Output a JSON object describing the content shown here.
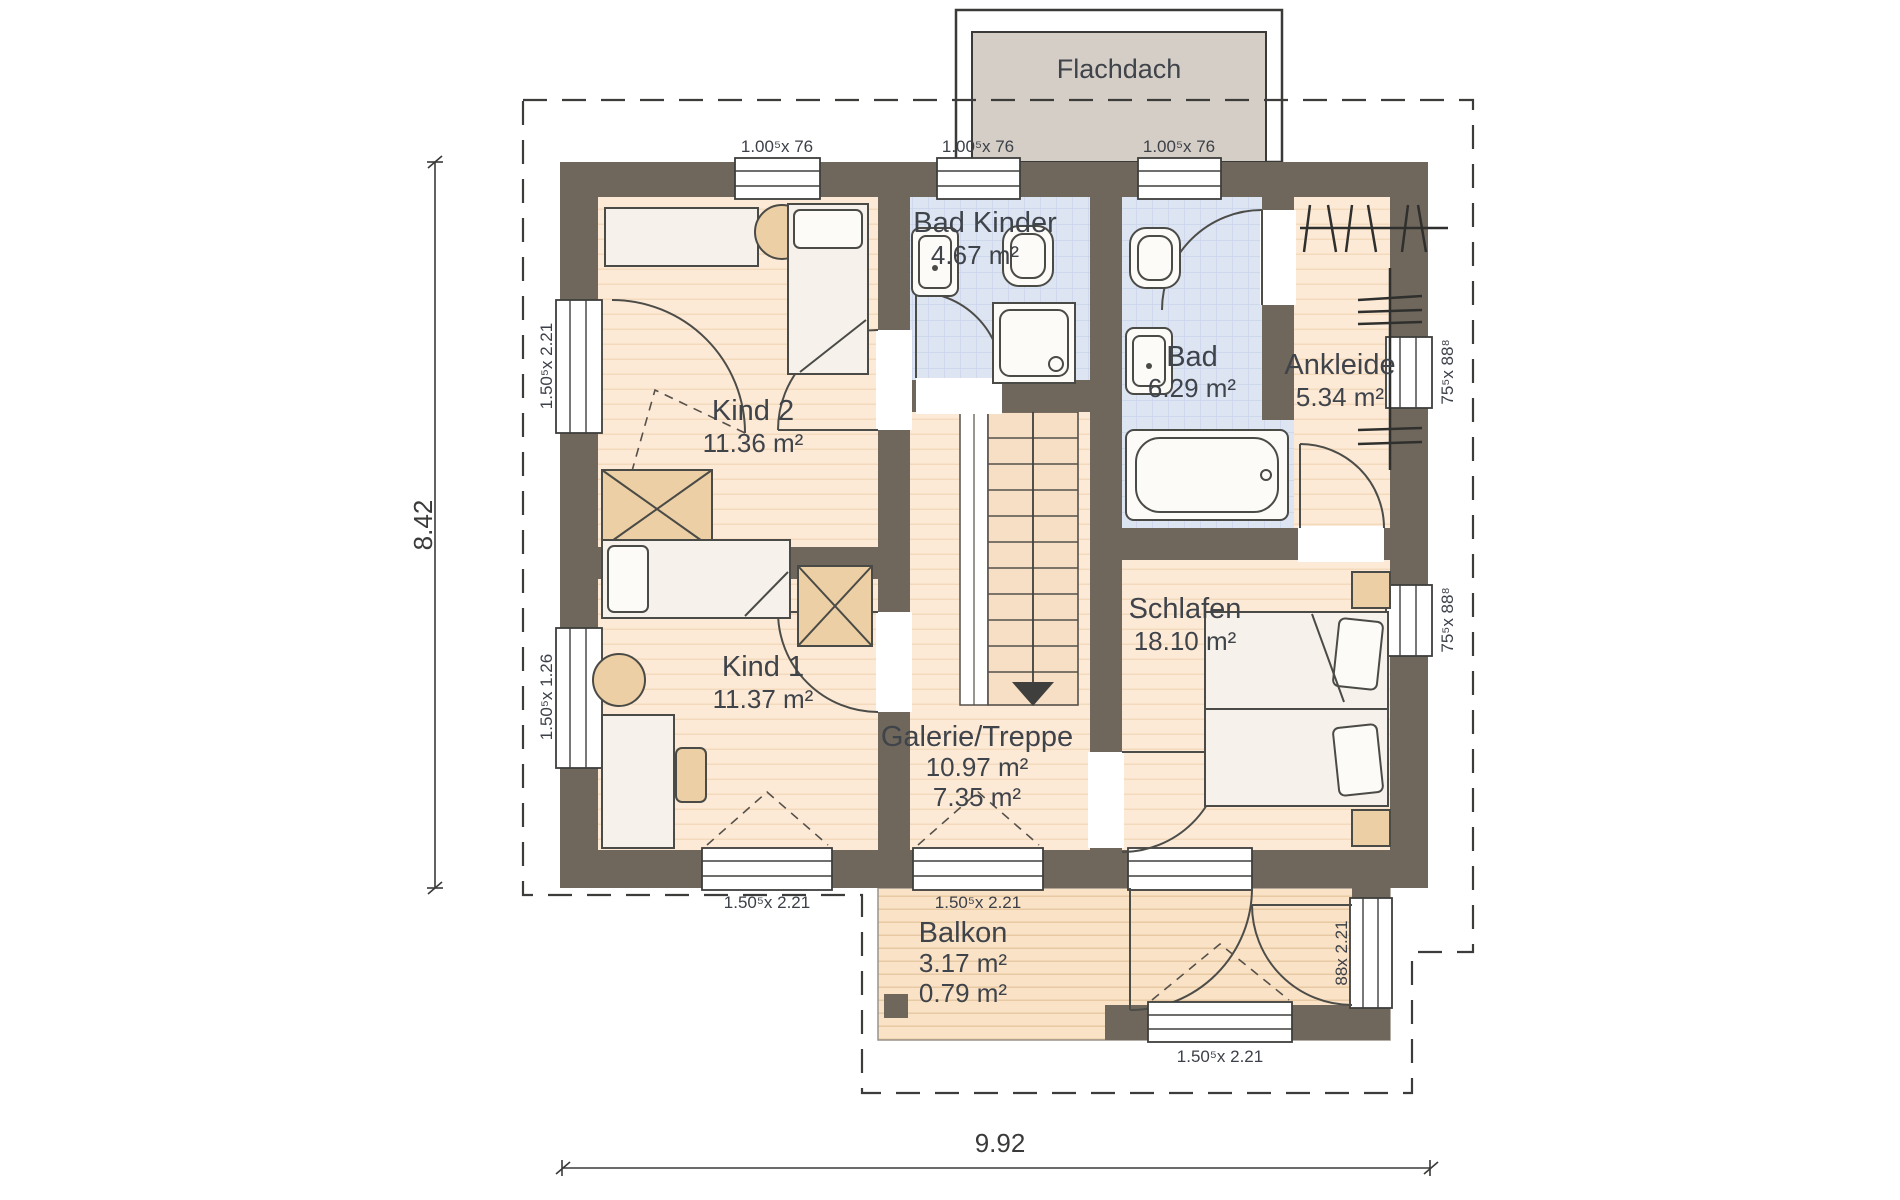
{
  "labels": {
    "roof": "Flachdach",
    "dim_height": "8.42",
    "dim_width": "9.92"
  },
  "rooms": {
    "bad_kinder": {
      "name": "Bad Kinder",
      "area": "4.67 m²"
    },
    "bad": {
      "name": "Bad",
      "area": "6.29 m²"
    },
    "ankleide": {
      "name": "Ankleide",
      "area": "5.34 m²"
    },
    "kind2": {
      "name": "Kind 2",
      "area": "11.36 m²"
    },
    "kind1": {
      "name": "Kind 1",
      "area": "11.37 m²"
    },
    "schlafen": {
      "name": "Schlafen",
      "area": "18.10 m²"
    },
    "galerie": {
      "name": "Galerie/Treppe",
      "area": "10.97 m²",
      "area2": "7.35 m²"
    },
    "balkon": {
      "name": "Balkon",
      "area": "3.17 m²",
      "area2": "0.79 m²"
    }
  },
  "window_labels": {
    "top_left": "1.00⁵x 76",
    "top_center": "1.00⁵x 76",
    "top_right": "1.00⁵x 76",
    "left_upper": "1.50⁵x 2.21",
    "left_lower": "1.50⁵x 1.26",
    "right_upper": "75⁵x 88⁸",
    "right_lower": "75⁵x 88⁸",
    "bottom_left": "1.50⁵x 2.21",
    "bottom_center": "1.50⁵x 2.21",
    "balcony_bottom": "1.50⁵x 2.21",
    "balcony_right": "88x 2.21"
  },
  "colors": {
    "wall": "#6f675c",
    "floor": "#fcead6",
    "tile": "#dde4f2",
    "roof_fill": "#d5cec6",
    "balcony_floor": "#fae2c6",
    "furniture_tan": "#eccfa4"
  }
}
